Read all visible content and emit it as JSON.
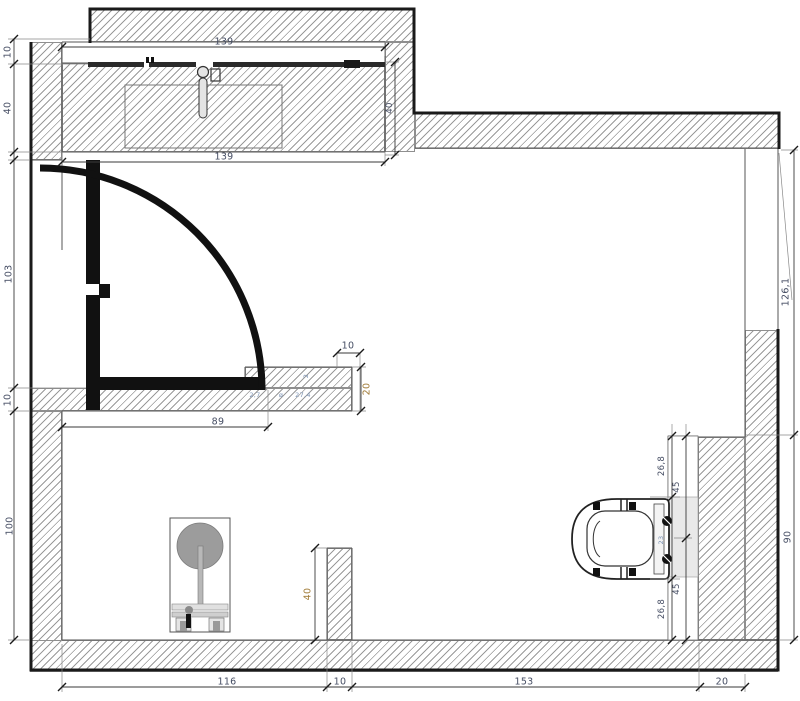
{
  "drawing_type": "bathroom-floor-plan",
  "colors": {
    "wall_hatch": "#9a9a9a",
    "outline": "#1a1a1a",
    "dim_text": "#454d63",
    "dim_text_accent": "#a07a35",
    "dim_text_small": "#7d94b5",
    "prewall_fill": "#e9e9e9",
    "fixture_gray": "#9c9c9c"
  },
  "dims": {
    "counter_width_top": "139",
    "counter_width_bottom": "139",
    "shelf_depth": "10",
    "counter_depth_left": "40",
    "counter_depth_right": "40",
    "door_opening": "103",
    "jamb_thickness": "10",
    "room_left_height": "100",
    "door_clearance": "89",
    "partition_segment": "10",
    "partition_depth": "20",
    "partition_tiny_1": "2",
    "partition_tiny_2": "2,7",
    "partition_tiny_3": "ø",
    "partition_tiny_4": "27,4",
    "stub_length": "40",
    "bottom_1": "116",
    "bottom_2": "10",
    "bottom_3": "153",
    "bottom_4": "20",
    "wc_top_offset": "26,8",
    "wc_top_half": "45",
    "wc_bolt_span": "23",
    "wc_bottom_half": "45",
    "wc_bottom_offset": "26,8",
    "right_upper_height": "126,1",
    "right_lower_height": "90"
  }
}
